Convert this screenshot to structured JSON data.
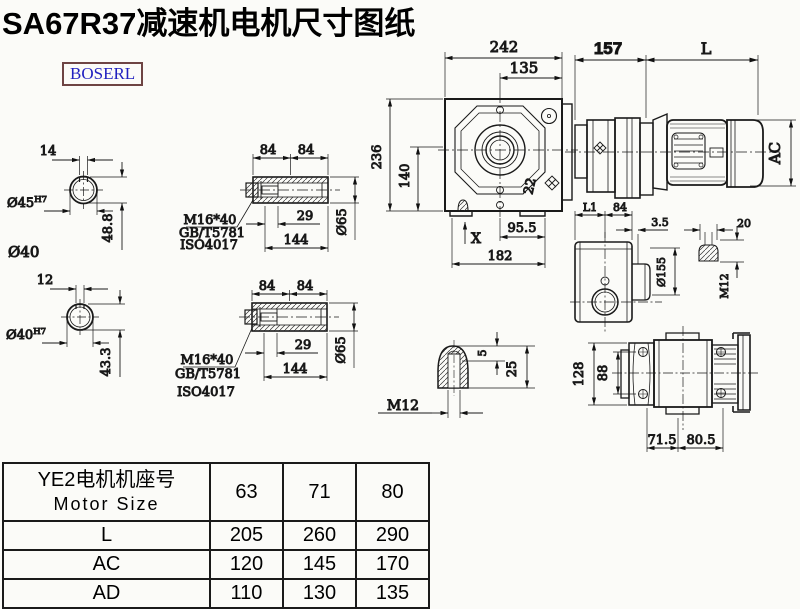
{
  "title": "SA67R37减速机电机尺寸图纸",
  "logo": "BOSERL",
  "colors": {
    "line": "#1a1a1a",
    "logo_text": "#1f1fbf",
    "logo_border": "#6e4444",
    "bg": "#fbfbf8"
  },
  "solid_shaft_top": {
    "key_width": "14",
    "diameter": "Ø45",
    "fit": "H7",
    "depth": "48.8",
    "note": "Ø40"
  },
  "solid_shaft_bottom": {
    "key_width": "12",
    "diameter": "Ø40",
    "fit": "H7",
    "depth": "43.3"
  },
  "hollow_shaft_top": {
    "len_a": "84",
    "len_b": "84",
    "bolt": "M16*40",
    "std_gb": "GB/T5781",
    "std_iso": "ISO4017",
    "inset": "29",
    "length": "144",
    "diameter": "Ø65"
  },
  "hollow_shaft_bottom": {
    "len_a": "84",
    "len_b": "84",
    "bolt": "M16*40",
    "std_gb": "GB/T5781",
    "std_iso": "ISO4017",
    "inset": "29",
    "length": "144",
    "diameter": "Ø65"
  },
  "front_view": {
    "width": "242",
    "center_offset": "135",
    "height": "236",
    "axis_height": "140",
    "angle": "22",
    "base_mark": "X",
    "bolt_span": "95.5",
    "base_width": "182"
  },
  "side_view": {
    "gear_length": "157",
    "motor_length": "L",
    "motor_od": "AC",
    "dim_l1": "L1",
    "dim_84": "84"
  },
  "small_side_view": {
    "flange_thk": "3.5",
    "flange_od": "Ø155",
    "stud_len": "20",
    "stud_thread": "M12"
  },
  "plug_detail": {
    "dim_5": "5",
    "dim_25": "25",
    "thread": "M12"
  },
  "rear_view": {
    "flange_h": "128",
    "bolt_span": "88",
    "foot_a": "71.5",
    "foot_b": "80.5"
  },
  "spec_table": {
    "header_cn": "YE2电机机座号",
    "header_en": "Motor Size",
    "sizes": [
      "63",
      "71",
      "80"
    ],
    "rows": [
      {
        "label": "L",
        "values": [
          "205",
          "260",
          "290"
        ]
      },
      {
        "label": "AC",
        "values": [
          "120",
          "145",
          "170"
        ]
      },
      {
        "label": "AD",
        "values": [
          "110",
          "130",
          "135"
        ]
      }
    ]
  }
}
